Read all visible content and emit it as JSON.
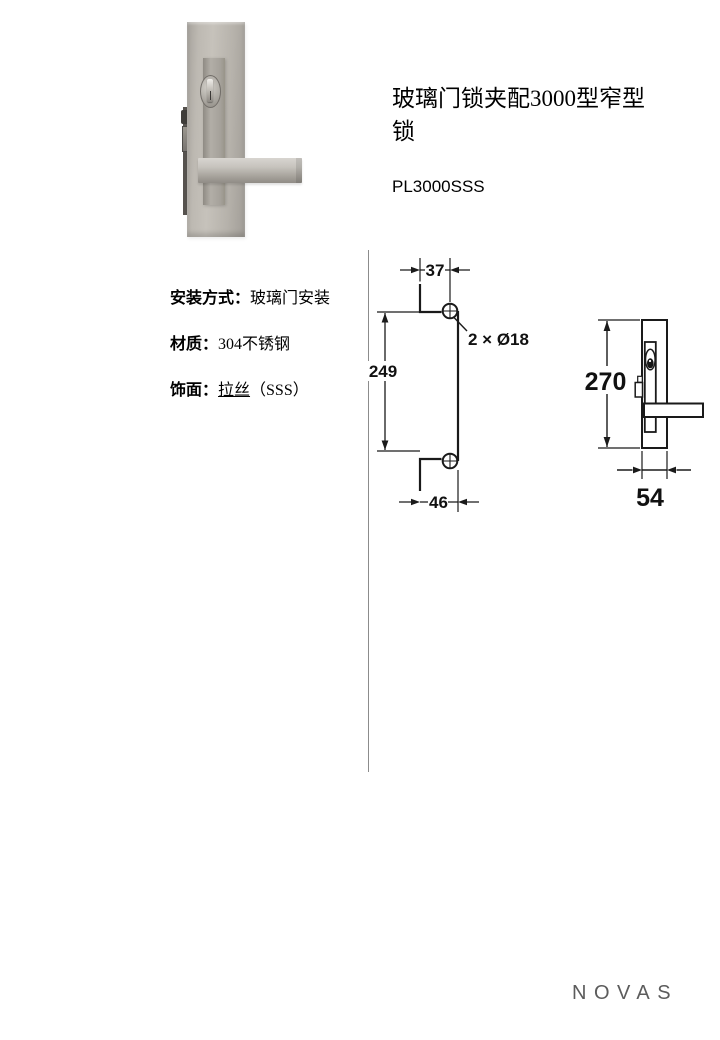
{
  "page": {
    "title": "玻璃门锁夹配3000型窄型锁",
    "product_code": "PL3000SSS",
    "brand": "NOVAS"
  },
  "specs": {
    "items": [
      {
        "label": "安装方式：",
        "value": "玻璃门安装"
      },
      {
        "label": "材质：",
        "value": "304不锈钢"
      },
      {
        "label": "饰面：",
        "value": "拉丝",
        "suffix": "（SSS）"
      }
    ]
  },
  "drawings": {
    "front_view": {
      "top_width": "37",
      "height": "249",
      "bottom_width": "46",
      "holes_callout": "2 × Ø18"
    },
    "side_view": {
      "height": "270",
      "width": "54"
    }
  },
  "photo": {
    "subject": "brushed-stainless-glass-door-lock-with-square-lever"
  },
  "colors": {
    "drawing_line": "#1a1a1a",
    "divider": "#8c8c8c",
    "brand_gray": "#5c5c5c",
    "steel": "#b3afa8"
  }
}
